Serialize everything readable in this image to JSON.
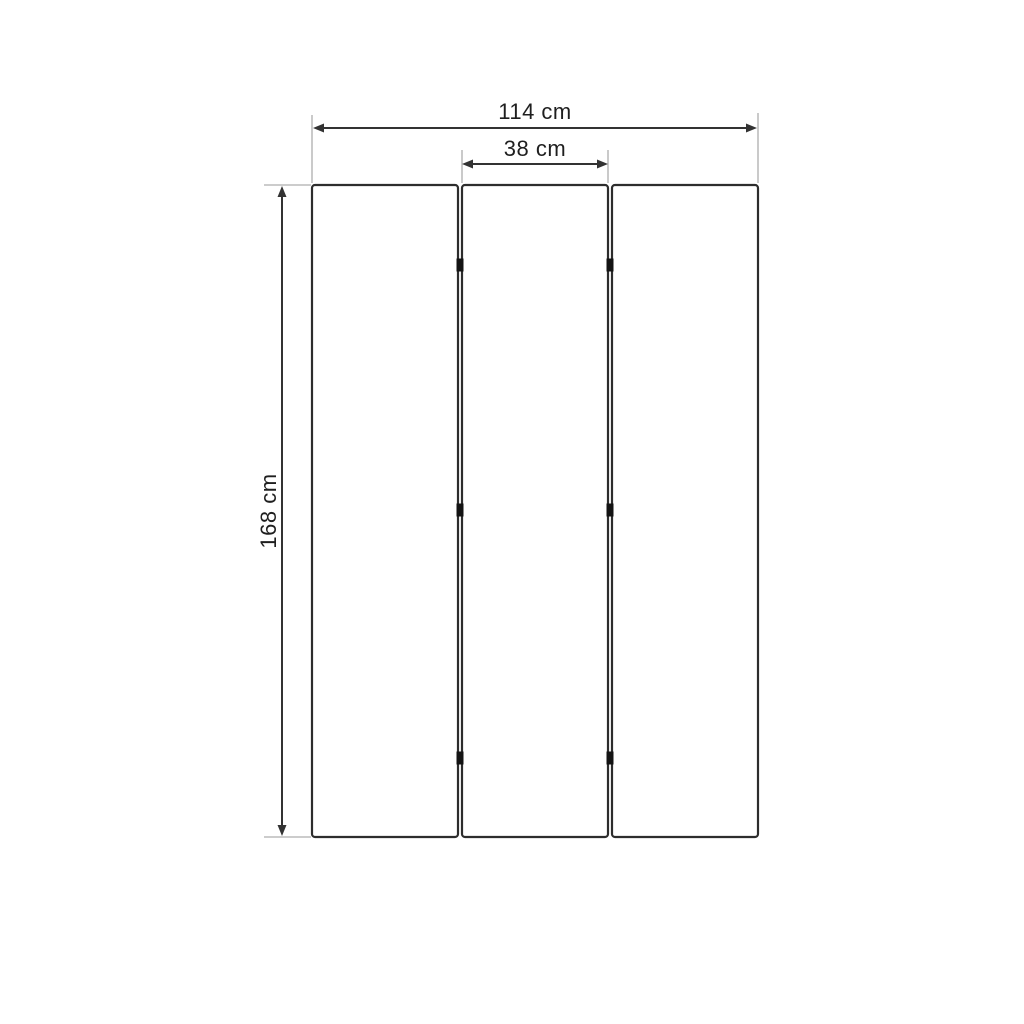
{
  "diagram": {
    "labels": {
      "total_width": "114 cm",
      "panel_width": "38 cm",
      "height": "168 cm"
    },
    "values": {
      "total_width_cm": 114,
      "panel_width_cm": 38,
      "height_cm": 168,
      "panel_count": 3,
      "hinges_per_gap": 3,
      "unit": "cm"
    },
    "colors": {
      "background": "#ffffff",
      "panel_stroke": "#2d2d2d",
      "dimension_line": "#333333",
      "extension_line": "#aeaeae",
      "hinge_fill": "#141414",
      "label_text": "#1f1f1f"
    }
  }
}
